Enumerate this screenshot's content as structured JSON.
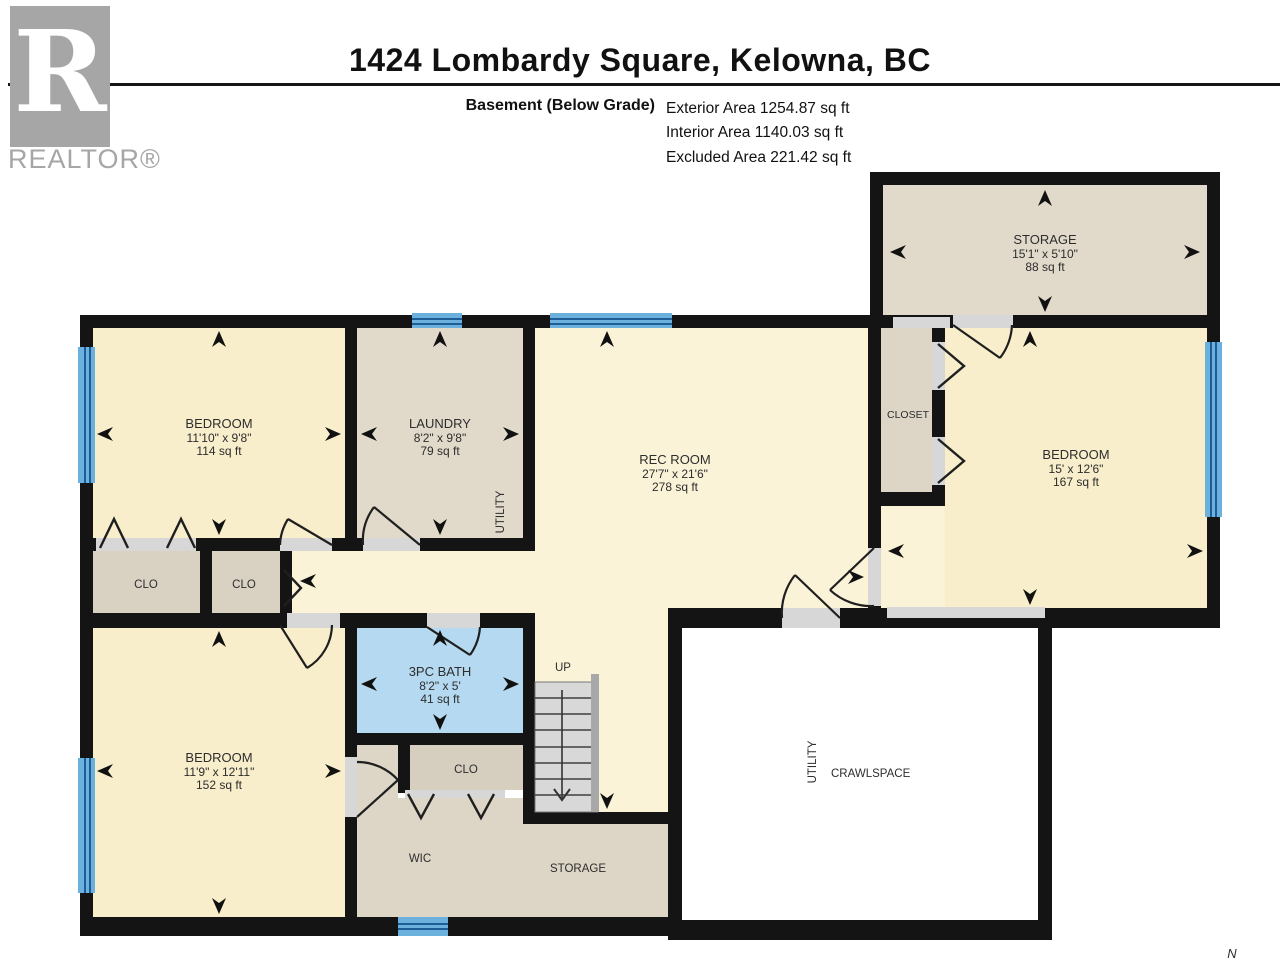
{
  "header": {
    "title": "1424 Lombardy Square, Kelowna, BC",
    "floor_label": "Basement (Below Grade)",
    "stats": [
      "Exterior Area 1254.87 sq ft",
      "Interior Area 1140.03 sq ft",
      "Excluded Area 221.42 sq ft"
    ]
  },
  "logo": {
    "letter": "R",
    "brand": "REALTOR®"
  },
  "compass": {
    "north": "N"
  },
  "plan": {
    "rooms": {
      "storage_top": {
        "name": "STORAGE",
        "dims": "15'1\" x 5'10\"",
        "area": "88 sq ft"
      },
      "bedroom_top_left": {
        "name": "BEDROOM",
        "dims": "11'10\" x 9'8\"",
        "area": "114 sq ft"
      },
      "laundry": {
        "name": "LAUNDRY",
        "dims": "8'2\" x 9'8\"",
        "area": "79 sq ft"
      },
      "utility_laundry": {
        "name": "UTILITY"
      },
      "rec_room": {
        "name": "REC ROOM",
        "dims": "27'7\" x 21'6\"",
        "area": "278 sq ft"
      },
      "closet_right": {
        "name": "CLOSET"
      },
      "bedroom_right": {
        "name": "BEDROOM",
        "dims": "15' x 12'6\"",
        "area": "167 sq ft"
      },
      "closet_left": {
        "name": "CLO"
      },
      "closet_middle": {
        "name": "CLO"
      },
      "bedroom_bottom_left": {
        "name": "BEDROOM",
        "dims": "11'9\" x 12'11\"",
        "area": "152 sq ft"
      },
      "bath": {
        "name": "3PC BATH",
        "dims": "8'2\" x 5'",
        "area": "41 sq ft"
      },
      "stairs": {
        "name": "UP"
      },
      "closet_bath": {
        "name": "CLO"
      },
      "wic": {
        "name": "WIC"
      },
      "storage_bottom": {
        "name": "STORAGE"
      },
      "crawlspace": {
        "name": "CRAWLSPACE"
      },
      "utility_crawlspace": {
        "name": "UTILITY"
      }
    }
  },
  "colors": {
    "wall": "#141414",
    "bedroom_fill": "#f8eecb",
    "rec_fill": "#fbf3d8",
    "storage_fill": "#e1dacb",
    "closet_fill": "#d9d2c3",
    "wic_fill": "#ddd5c5",
    "bath_fill": "#b5d9f0",
    "window_blue": "#6cb0de",
    "window_stripe": "#1d5c95",
    "opening_gray": "#d7d7d7",
    "stair_gray": "#d8d8d8",
    "crawlspace_fill": "#ffffff",
    "logo_gray": "#a6a6a6"
  },
  "icons": {
    "dimension_arrow": "solid triangle",
    "door_swing": "quarter-arc",
    "bifold_door": "chevron",
    "window": "striped blue band"
  }
}
